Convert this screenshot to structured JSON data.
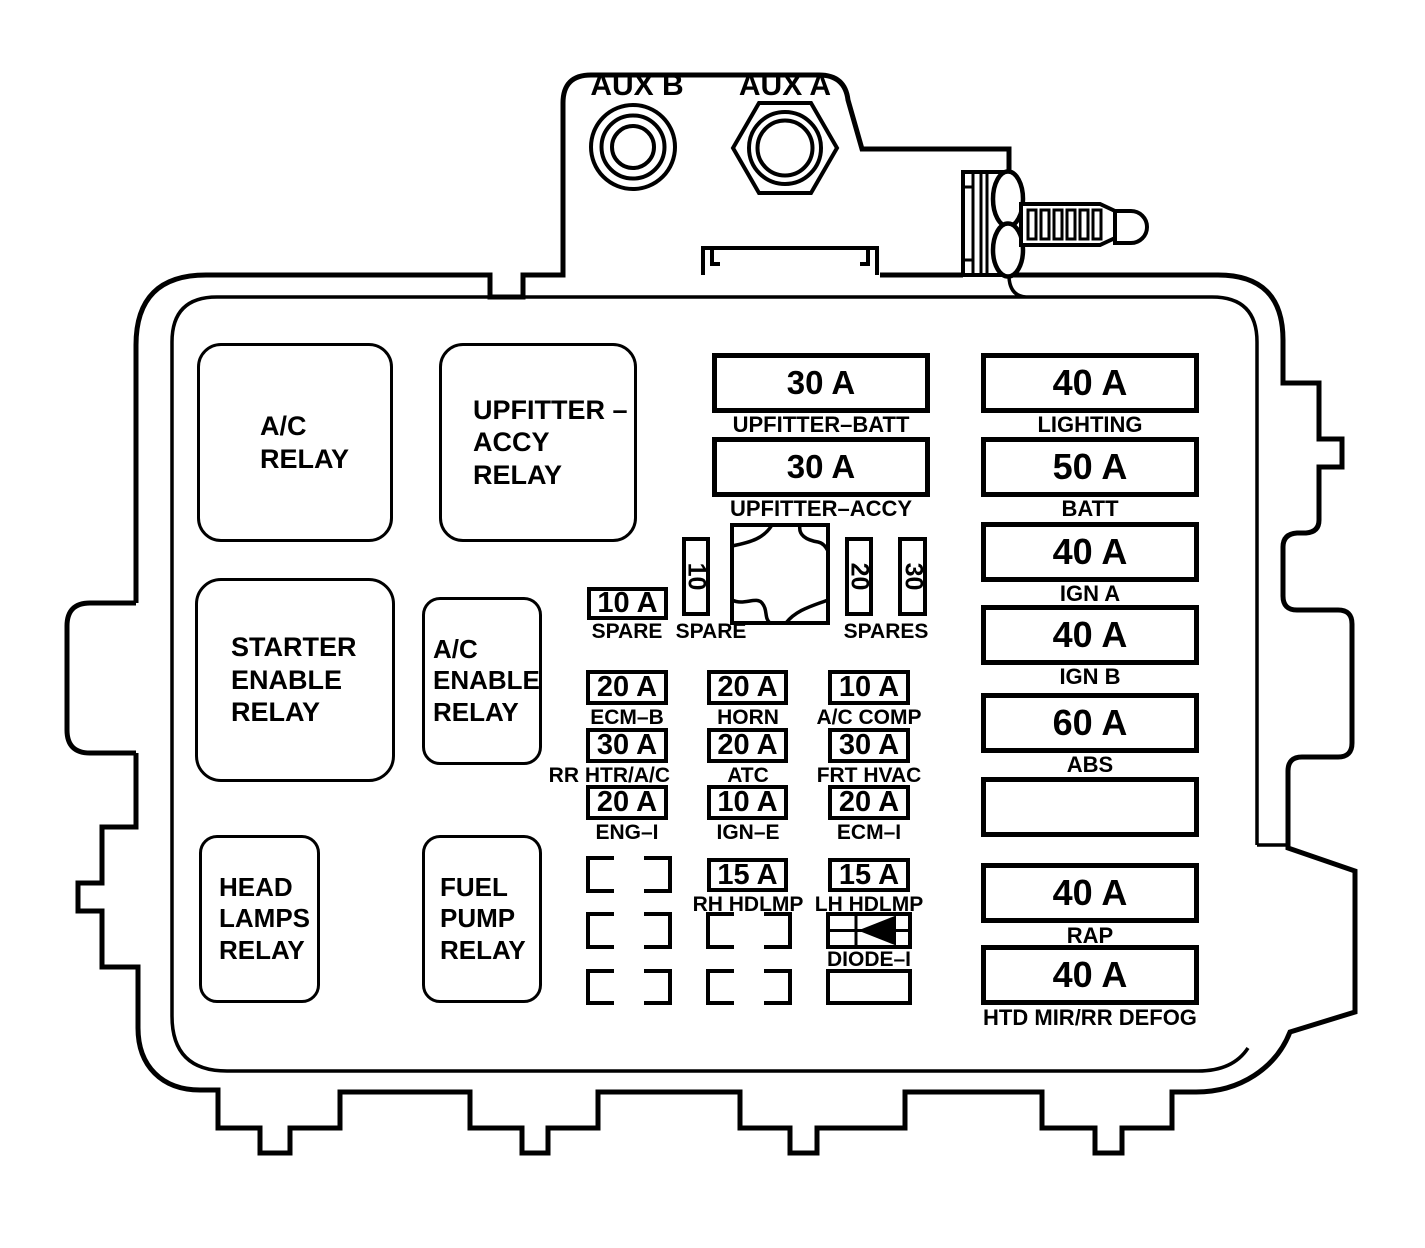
{
  "colors": {
    "ink": "#000000",
    "background": "#ffffff"
  },
  "aux": {
    "b": "AUX B",
    "a": "AUX A"
  },
  "relays": [
    {
      "label": "A/C\nRELAY"
    },
    {
      "label": "UPFITTER –\nACCY\nRELAY"
    },
    {
      "label": "STARTER\nENABLE\nRELAY"
    },
    {
      "label": "A/C\nENABLE\nRELAY"
    },
    {
      "label": "HEAD\nLAMPS\nRELAY"
    },
    {
      "label": "FUEL\nPUMP\nRELAY"
    }
  ],
  "upfitter_fuses": [
    {
      "amp": "30 A",
      "label": "UPFITTER–BATT"
    },
    {
      "amp": "30 A",
      "label": "UPFITTER–ACCY"
    }
  ],
  "spares": {
    "flat_amp": "10 A",
    "flat_label": "SPARE",
    "mini_amp": "10",
    "mini_label": "SPARE",
    "mini2_amp": "20",
    "mini3_amp": "30",
    "group_label": "SPARES"
  },
  "fuse_grid": [
    [
      {
        "amp": "20 A",
        "label": "ECM–B"
      },
      {
        "amp": "20 A",
        "label": "HORN"
      },
      {
        "amp": "10 A",
        "label": "A/C COMP"
      }
    ],
    [
      {
        "amp": "30 A",
        "label": "RR HTR/A/C"
      },
      {
        "amp": "20 A",
        "label": "ATC"
      },
      {
        "amp": "30 A",
        "label": "FRT HVAC"
      }
    ],
    [
      {
        "amp": "20 A",
        "label": "ENG–I"
      },
      {
        "amp": "10 A",
        "label": "IGN–E"
      },
      {
        "amp": "20 A",
        "label": "ECM–I"
      }
    ],
    [
      {
        "amp": "15 A",
        "label": "RH HDLMP"
      },
      {
        "amp": "15 A",
        "label": "LH HDLMP"
      }
    ]
  ],
  "diode_label": "DIODE–I",
  "right_fuses": [
    {
      "amp": "40 A",
      "label": "LIGHTING"
    },
    {
      "amp": "50 A",
      "label": "BATT"
    },
    {
      "amp": "40 A",
      "label": "IGN A"
    },
    {
      "amp": "40 A",
      "label": "IGN B"
    },
    {
      "amp": "60 A",
      "label": "ABS"
    },
    {
      "amp": "",
      "label": ""
    },
    {
      "amp": "40 A",
      "label": "RAP"
    },
    {
      "amp": "40 A",
      "label": "HTD MIR/RR DEFOG"
    }
  ]
}
